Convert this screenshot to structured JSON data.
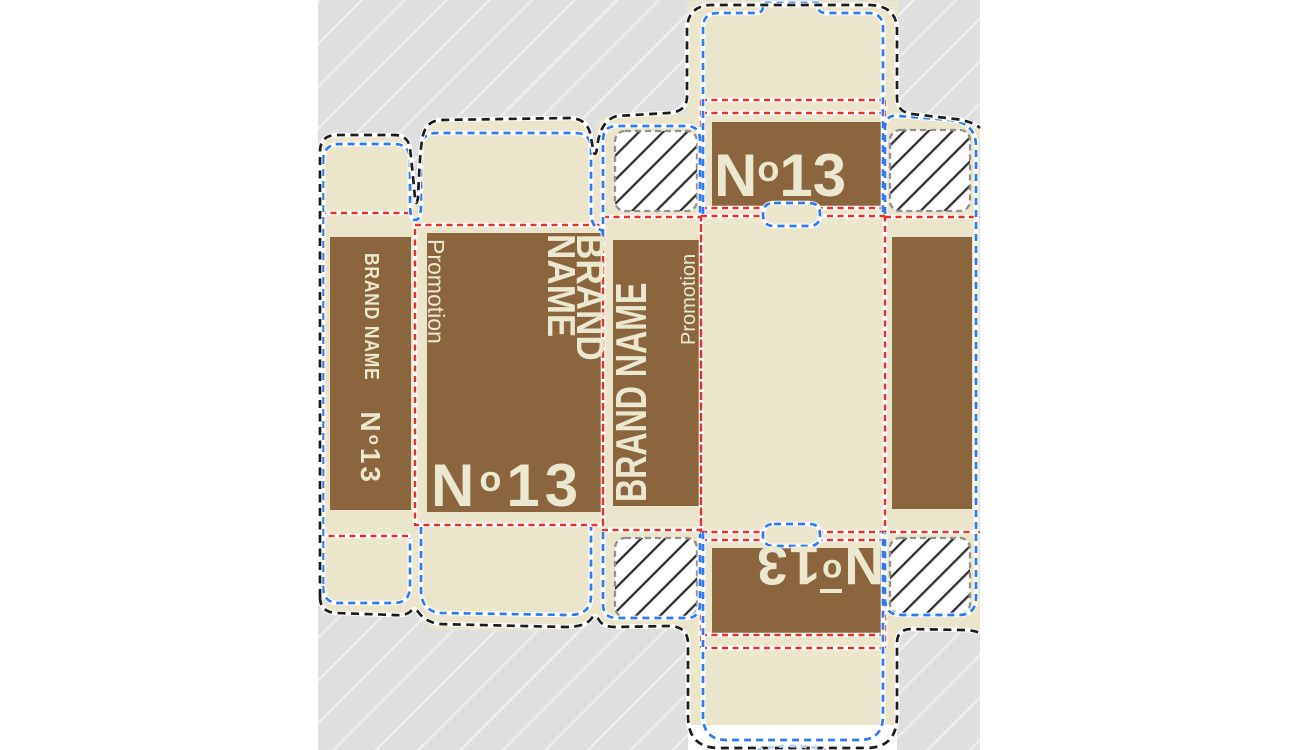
{
  "view": {
    "type": "packaging dieline design canvas",
    "page_background": "#ffffff",
    "canvas_background": "#dfdfdf",
    "canvas_stripe": "#eeeeee"
  },
  "dieline": {
    "substrate_color": "#ebe6cb",
    "print_color": "#8a653e",
    "label_color": "#ece8cf",
    "lines": {
      "cut": {
        "label": "cut line",
        "color": "#1c1c1c"
      },
      "crease": {
        "label": "crease / fold line",
        "color": "#e8312c"
      },
      "bleed": {
        "label": "bleed / safety line",
        "color": "#2e7bf0"
      },
      "glue": {
        "label": "glue area border",
        "color": "#909090"
      },
      "guide": {
        "label": "guide line",
        "color": "#b9d2f5"
      }
    },
    "text": {
      "brand": "BRAND NAME",
      "brand_line1": "BRAND",
      "brand_line2": "NAME",
      "promotion": "Promotion",
      "number_full": "N°13",
      "number": {
        "n": "N",
        "ring": "o",
        "digits": "13"
      }
    },
    "panels": {
      "left_side": "side panel with BRAND NAME and N°13 (text rotated 90°)",
      "front": "front panel with Promotion, BRAND NAME and N°13",
      "right_side": "side panel with BRAND NAME and Promotion (text rotated -90°)",
      "back_top": "top closure panel with N°13",
      "back_bottom": "bottom closure panel with N°13 rotated 180°",
      "glue_flap": "unprinted glue flap",
      "glue_areas": "4 hatched glue zones"
    }
  }
}
